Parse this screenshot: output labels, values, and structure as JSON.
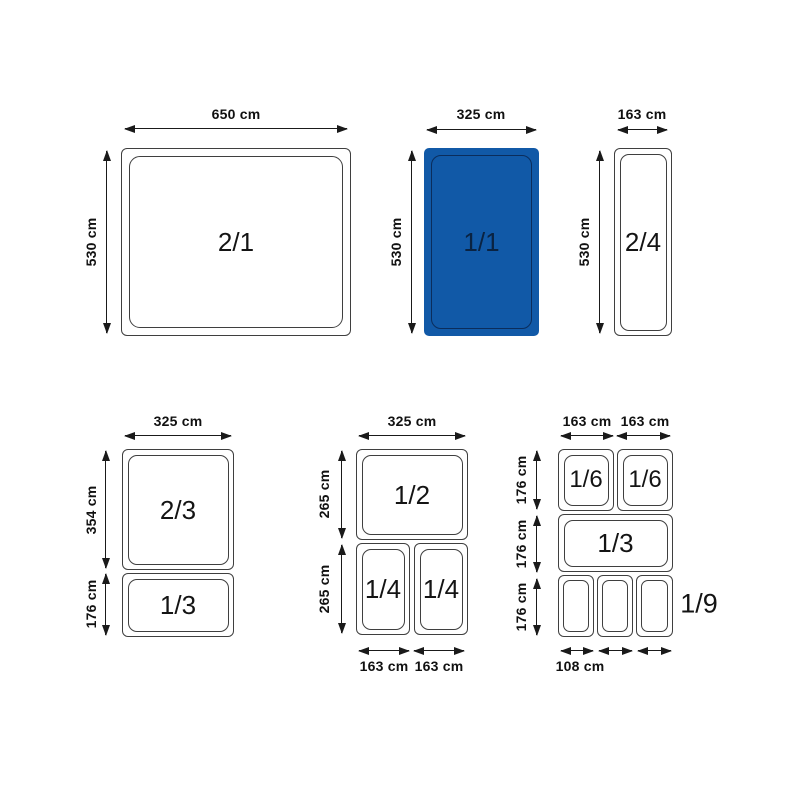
{
  "diagram_title": "Gastronorm pan sizes",
  "colors": {
    "highlight_fill": "#1159a7",
    "highlight_line": "#0b2d5c",
    "outline": "#3f3f3f",
    "text": "#141414"
  },
  "pans": {
    "g1": {
      "size": "2/1",
      "width": "650 cm",
      "height": "530 cm"
    },
    "g2": {
      "size": "1/1",
      "width": "325 cm",
      "height": "530 cm",
      "highlighted": "true"
    },
    "g3": {
      "size": "2/4",
      "width": "163 cm",
      "height": "530 cm"
    },
    "g4": {
      "width": "325 cm",
      "height1": "354 cm",
      "height2": "176 cm",
      "size1": "2/3",
      "size2": "1/3"
    },
    "g5": {
      "width": "325 cm",
      "height1": "265 cm",
      "height2": "265 cm",
      "size1": "1/2",
      "size2": "1/4",
      "size3": "1/4",
      "bottom1": "163 cm",
      "bottom2": "163 cm"
    },
    "g6": {
      "top1": "163 cm",
      "top2": "163 cm",
      "height1": "176 cm",
      "height2": "176 cm",
      "height3": "176 cm",
      "size1": "1/6",
      "size2": "1/6",
      "size3": "1/3",
      "size4": "1/9",
      "bottom": "108 cm"
    }
  }
}
